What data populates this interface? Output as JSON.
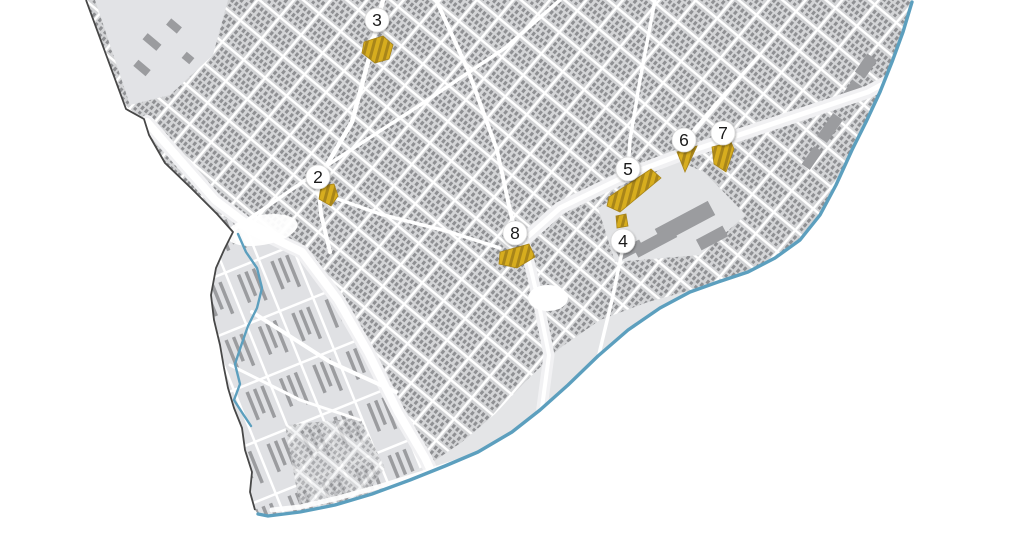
{
  "map": {
    "width": 1024,
    "height": 540,
    "marker_radius": 12,
    "markers": [
      {
        "label": "2",
        "x": 318,
        "y": 177
      },
      {
        "label": "3",
        "x": 377,
        "y": 20
      },
      {
        "label": "4",
        "x": 623,
        "y": 241
      },
      {
        "label": "5",
        "x": 628,
        "y": 169
      },
      {
        "label": "6",
        "x": 684,
        "y": 140
      },
      {
        "label": "7",
        "x": 723,
        "y": 133
      },
      {
        "label": "8",
        "x": 515,
        "y": 233
      }
    ],
    "sites": [
      {
        "id": "site-2",
        "points": "321,186 334,184 338,196 331,206 319,199"
      },
      {
        "id": "site-3",
        "points": "364,42 383,36 393,45 389,59 375,63 362,53"
      },
      {
        "id": "site-4",
        "points": "616,216 626,214 628,226 617,228"
      },
      {
        "id": "site-5",
        "points": "609,197 651,169 661,178 620,212 607,206"
      },
      {
        "id": "site-6",
        "points": "677,152 697,146 685,172"
      },
      {
        "id": "site-7",
        "points": "712,147 731,142 734,149 726,172 714,164"
      },
      {
        "id": "site-8",
        "points": "500,252 529,244 535,257 517,268 499,264"
      }
    ]
  },
  "colors": {
    "background": "#ffffff",
    "district_base": "#e9eaec",
    "dense_block": "#d3d4d6",
    "building": "#8f9093",
    "sparse_block": "#e0e1e4",
    "industrial_building": "#9b9c9f",
    "meadow": "#e4e5e7",
    "road": "#ffffff",
    "highway_band": "#f1f1f3",
    "boundary_dark": "#474747",
    "water": "#5c9fbe",
    "site_yellow": "#d7ad1e",
    "site_yellow_dark": "#a8851a",
    "marker_fill": "#ffffff",
    "marker_stroke": "#d9d9d9",
    "marker_text": "#1b1b1b"
  }
}
